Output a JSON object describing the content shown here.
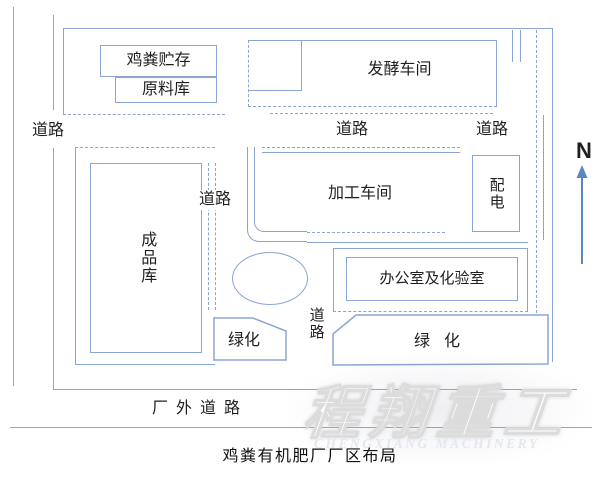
{
  "title": "鸡粪有机肥厂厂区布局",
  "compass": "N",
  "watermark": {
    "main": "程翔重工",
    "sub": "CHENGXIANG MACHINERY"
  },
  "blocks": {
    "manure_storage": "鸡粪贮存",
    "raw_material_store": "原料库",
    "fermentation_workshop": "发酵车间",
    "processing_workshop": "加工车间",
    "power_distribution": "配电",
    "finished_product_store": "成品库",
    "office_lab": "办公室及化验室",
    "green_left": "绿化",
    "green_right": "绿化"
  },
  "roads": {
    "left": "道路",
    "middle_top": "道路",
    "right_top": "道路",
    "middle_left": "道路",
    "center_vertical": "道路",
    "outside": "厂外道路"
  },
  "colors": {
    "line": "#8aa5d4",
    "text": "#1f1f1f",
    "arrow": "#5b86c4",
    "wm": "#e3e7ef"
  }
}
